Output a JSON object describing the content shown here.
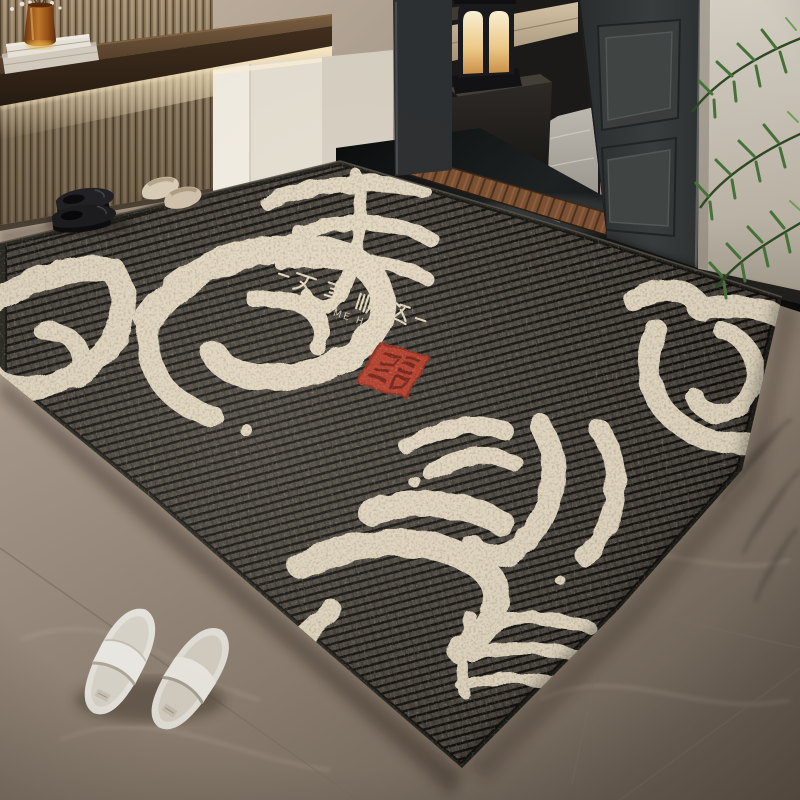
{
  "rug": {
    "message_cn": "万事顺遂",
    "message_display": "—万事顺遂—",
    "message_en": "WELCOME HOME",
    "large_characters": [
      "万",
      "事",
      "顺",
      "遂"
    ],
    "calligraphy_color": "#e9ddc6",
    "base_color": "#443f38",
    "groove_color": "#0d0c0a",
    "binding_color": "#23221c",
    "seal_color": "#b23420"
  },
  "palette": {
    "floor_marble": "#a29486",
    "slat_wall": "#b5a083",
    "shelf_wood": "#3a2b1c",
    "led_glow": "#ffe9b8",
    "white_cabinet": "#efe9dd",
    "door": "#35383a",
    "black_marble": "#101212",
    "threshold_wood": "#7c5134",
    "hall_marble": "#b6b1a8",
    "lantern_glow": "#f6dfa8",
    "plant_green": "#47763a",
    "vase_amber": "#c67c2c"
  },
  "objects": {
    "left_wall": "slat-wood-panel-wall",
    "shelf": "floating-wood-shelf",
    "books": "white-book-stack",
    "vase": "amber-glass-vase",
    "cabinet": "white-entry-cabinet",
    "lantern": "black-candle-lantern",
    "bench": "beige-bench-cushion",
    "fern": "fern-plant",
    "door": "dark-panel-door",
    "threshold": "wood-threshold-strip",
    "marble_strip": "black-marble-strip",
    "hallway": "marble-hallway-floor",
    "palm": "palm-plant-fronds",
    "rug": "striped-calligraphy-doormat",
    "black_shoes": "black-leather-loafers",
    "beige_slippers": "beige-slippers",
    "white_slippers": "white-slippers"
  }
}
